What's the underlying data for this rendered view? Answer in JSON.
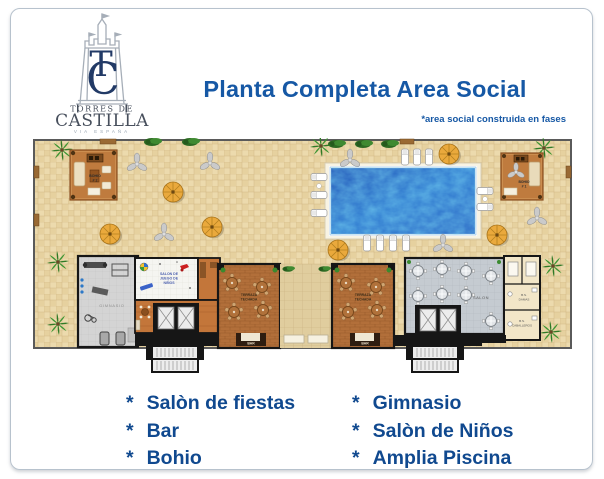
{
  "logo": {
    "monogram_t": "T",
    "monogram_c": "C",
    "line1": "TORRES DE",
    "line2": "CASTILLA",
    "line3": "VIA ESPAÑA"
  },
  "header": {
    "title": "Planta Completa Area Social",
    "note": "*area social construida en fases"
  },
  "plan": {
    "bohio2_l1": "BOHIO",
    "bohio2_l2": "# 2",
    "bohio1_l1": "BOHIO",
    "bohio1_l2": "# 1",
    "kids_l1": "SALON DE",
    "kids_l2": "JUEGO DE",
    "kids_l3": "NIÑOS",
    "gym": "GIMNASIO",
    "terraza_l1": "TERRAZA",
    "terraza_l2": "TECHADA",
    "bar": "BAR",
    "salon": "SALON",
    "damas_l1": "B.S.",
    "damas_l2": "DAMAS",
    "caballeros_l1": "B.S.",
    "caballeros_l2": "CABALLEROS"
  },
  "features": {
    "bullet": "*",
    "left": [
      "Salòn de fiestas",
      "Bar",
      "Bohio"
    ],
    "right": [
      "Gimnasio",
      "Salòn de Niños",
      "Amplia Piscina"
    ]
  },
  "colors": {
    "accent_blue": "#1658a5",
    "pool_blue": "#2f7ad0",
    "terrace_tile": "#ecdaad",
    "wood": "#b26f3a"
  }
}
